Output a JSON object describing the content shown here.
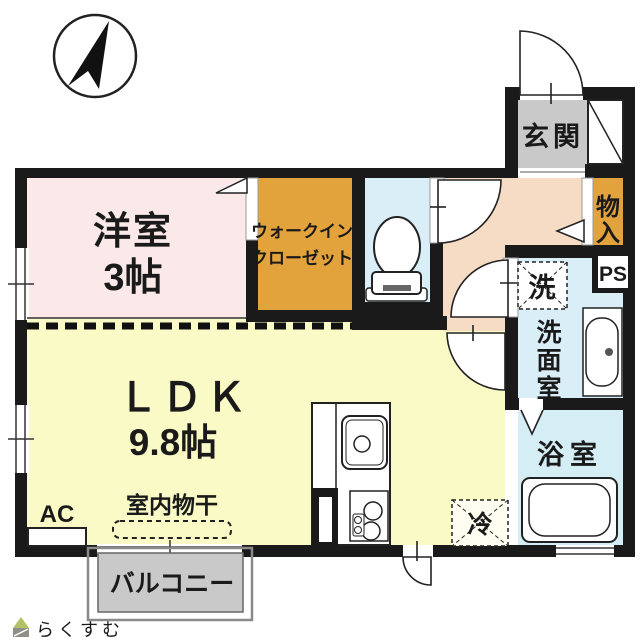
{
  "colors": {
    "wall": "#1a1a1a",
    "western_room": "#fbe9e9",
    "walk_in_closet": "#e3a33c",
    "toilet": "#daeef8",
    "hallway": "#f7dcc5",
    "ldk": "#f9fac5",
    "entrance_floor": "#c9c9c9",
    "storage": "#e3a33c",
    "washroom": "#daeef8",
    "bathroom": "#d5eef5",
    "balcony": "#c9c9c9"
  },
  "rooms": {
    "western_room": {
      "name": "洋室",
      "size": "3帖"
    },
    "walk_in_closet": {
      "label_line1": "ウォークイン",
      "label_line2": "クローゼット"
    },
    "ldk": {
      "name": "ＬＤＫ",
      "size": "9.8帖"
    },
    "entrance": {
      "label": "玄関"
    },
    "storage": {
      "label": "物入",
      "label_chars": [
        "物",
        "入"
      ]
    },
    "pipe_space": {
      "label": "PS"
    },
    "washroom": {
      "label": "洗面室",
      "label_chars": [
        "洗",
        "面",
        "室"
      ],
      "washing_machine_label": "洗"
    },
    "bathroom": {
      "label": "浴室"
    },
    "balcony": {
      "label": "バルコニー"
    }
  },
  "annotations": {
    "air_conditioner": "AC",
    "indoor_drying": "室内物干",
    "refrigerator": "冷",
    "watermark": "らくすむ"
  }
}
